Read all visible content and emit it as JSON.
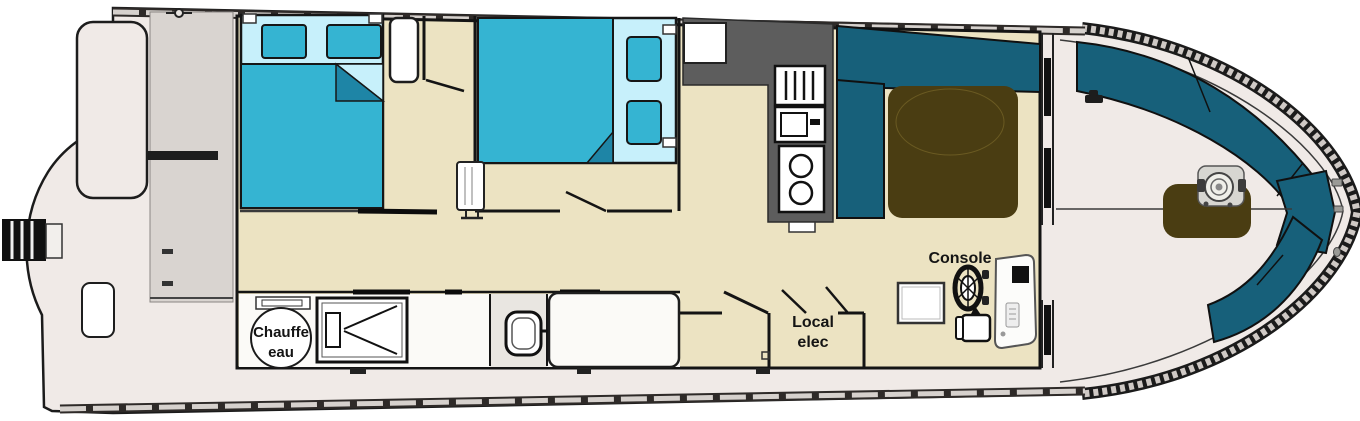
{
  "plan": {
    "type": "houseboat floor plan",
    "labels": {
      "console": "Console",
      "local_elec": [
        "Local",
        "elec"
      ],
      "chauffe_eau": [
        "Chauffe",
        "eau"
      ]
    },
    "colors": {
      "bed": "#35b4d2",
      "sheet": "#c7f0fb",
      "fold": "#1e85a6",
      "bench": "#17607a",
      "table": "#4a3d12",
      "counter": "#5d5d5d",
      "floor": "#ece3c2",
      "deck": "#f0eae7",
      "stern": "#d9d4d0",
      "white": "#ffffff"
    }
  }
}
